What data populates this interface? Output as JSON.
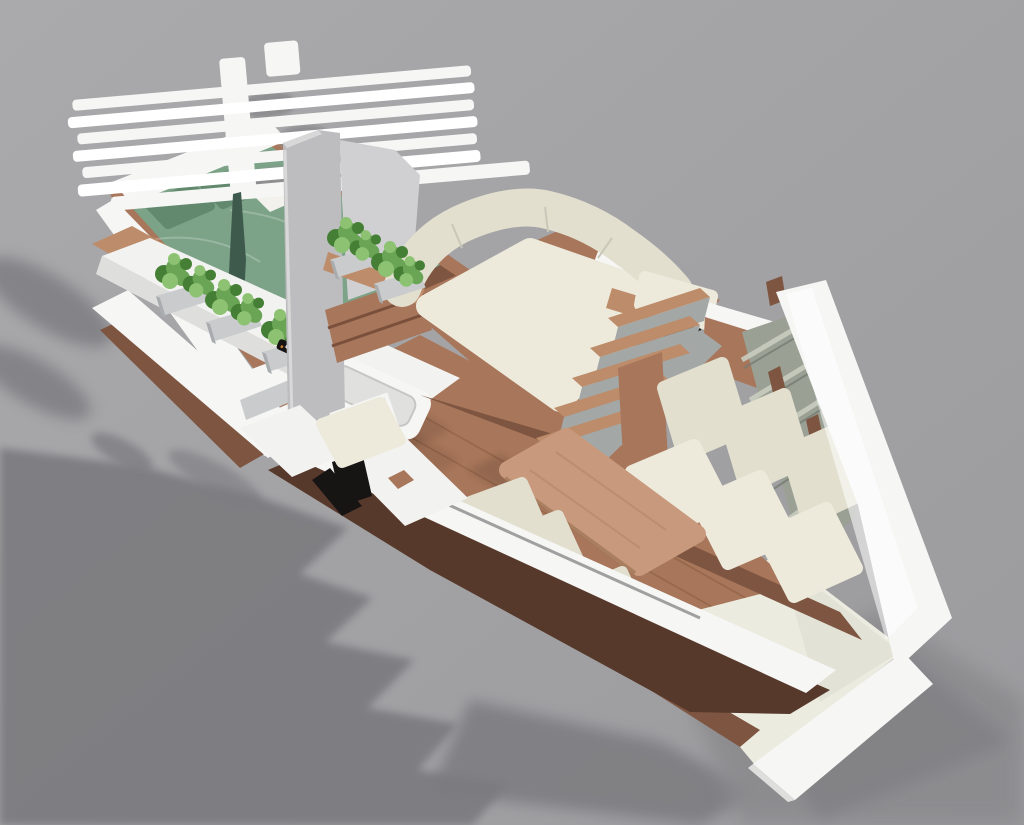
{
  "scene": {
    "type": "3d-render",
    "subject": "Cutaway concept render of a sailboat interior seen from an elevated three-quarter view on a plain gray studio backdrop",
    "canvas": {
      "width": 1024,
      "height": 825
    }
  },
  "palette": {
    "bg_light": "#aaaaac",
    "bg_dark": "#9b9b9e",
    "shadow": "#7c7c80",
    "shadow_soft": "#8b8b8e",
    "hull_white": "#f6f6f5",
    "hull_bright": "#ffffff",
    "hull_shade": "#dededd",
    "stern_cream": "#ecebdf",
    "wood": "#a8765a",
    "wood_light": "#bd8c6a",
    "wood_dark": "#7e5540",
    "wood_deep": "#57392b",
    "wood_table": "#c8997c",
    "plank_line": "#85583f",
    "cushion": "#e2dfcf",
    "cushion_hi": "#edeadc",
    "cushion_shade": "#cfccba",
    "bed_green": "#7ca288",
    "bed_green_dark": "#62886e",
    "plant": "#6aa455",
    "plant_dark": "#457f35",
    "plant_light": "#8cc272",
    "planter": "#c9cbcd",
    "planter_dark": "#a9acae",
    "partition": "#bdbdbf",
    "partition_light": "#d0d0d2",
    "louver": "#9aa094",
    "louver_light": "#c9cdc0",
    "louver_dark": "#767c72",
    "black": "#171514",
    "fin_green": "#3e5a4c",
    "desk_white": "#f2f2f0",
    "stair_gray": "#a3a8a6"
  },
  "objects": [
    {
      "id": "bow-hatch-slats",
      "label": "white slatted bow hatch"
    },
    {
      "id": "double-bed",
      "label": "double berth with green bedding and two pillows"
    },
    {
      "id": "herb-counter",
      "label": "white port counter with three planter troughs and sink"
    },
    {
      "id": "mast-partition",
      "label": "gray mast partition panels"
    },
    {
      "id": "daybed-lounge",
      "label": "large cream corner daybed on wooden platform with drawers"
    },
    {
      "id": "companionway-stairs",
      "label": "wooden steps with gray risers"
    },
    {
      "id": "nav-seat",
      "label": "black seat box with cream headrest and wooden cabinet"
    },
    {
      "id": "starboard-sofa",
      "label": "three-seat cream sofa along hull shelving"
    },
    {
      "id": "dining-table",
      "label": "rounded rectangular wooden saloon table"
    },
    {
      "id": "port-bench",
      "label": "port bench cushions along cutaway hull"
    },
    {
      "id": "desk-and-stool",
      "label": "white fold-out desk with cream stool"
    },
    {
      "id": "stern-deck",
      "label": "cream aft deck and white transom"
    },
    {
      "id": "ground-shadow",
      "label": "soft cast shadow on studio floor"
    }
  ]
}
